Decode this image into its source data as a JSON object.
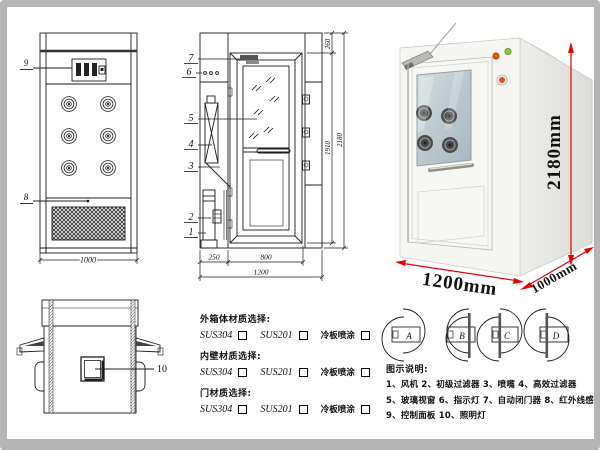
{
  "doc": {
    "background": "#ffffff",
    "frame_color": "#b5b5b5",
    "line_color": "#1c1c1c"
  },
  "front_view": {
    "label_9": "9",
    "label_8": "8",
    "width_dim": "1000"
  },
  "side_view": {
    "labels": [
      "7",
      "6",
      "5",
      "4",
      "3",
      "2",
      "1"
    ],
    "dim_left": "250",
    "dim_door": "800",
    "dim_total": "1200",
    "dim_top": "260",
    "dim_inner": "1910",
    "dim_height": "2180"
  },
  "plan_view": {
    "label_10": "10"
  },
  "photo": {
    "dim_height": "2180mm",
    "dim_width": "1200mm",
    "dim_depth": "1000mm",
    "dim_color": "#e80000"
  },
  "materials": {
    "groups": [
      {
        "title": "外箱体材质选择:",
        "options": [
          "SUS304",
          "SUS201",
          "冷板喷涂"
        ]
      },
      {
        "title": "内壁材质选择:",
        "options": [
          "SUS304",
          "SUS201",
          "冷板喷涂"
        ]
      },
      {
        "title": "门材质选择:",
        "options": [
          "SUS304",
          "SUS201",
          "冷板喷涂"
        ]
      }
    ]
  },
  "door_diagrams": {
    "labels": [
      "A",
      "B",
      "C",
      "D"
    ]
  },
  "legend": {
    "title": "图示说明:",
    "lines": [
      "1、风机      2、初级过滤器      3、喷嘴      4、高效过滤器",
      "5、玻璃视窗     6、指示灯     7、自动闭门器     8、红外线感应器",
      "9、控制面板      10、照明灯"
    ]
  }
}
